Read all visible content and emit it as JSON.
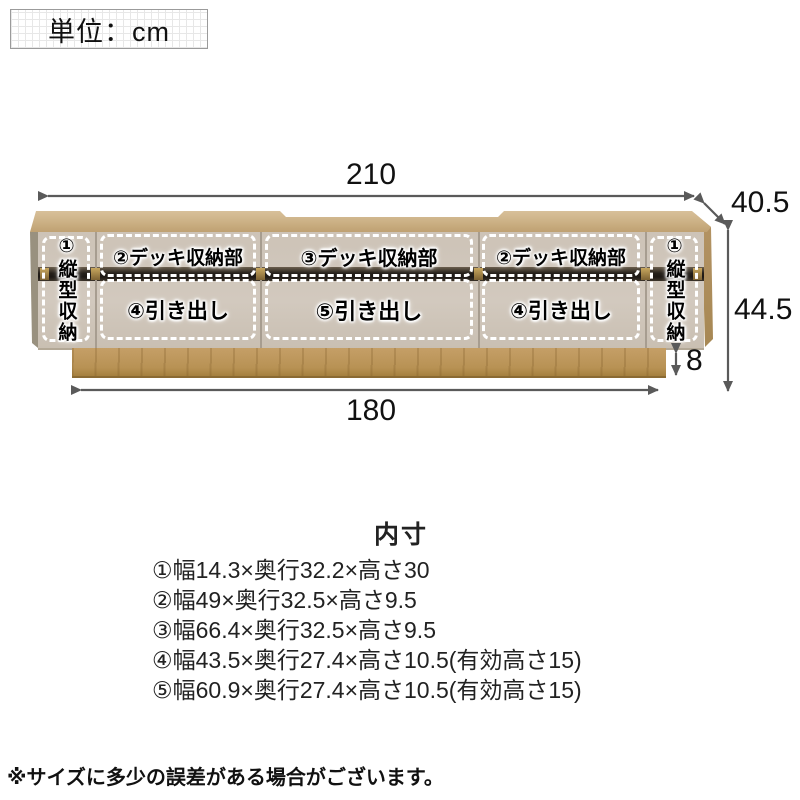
{
  "unit_box": {
    "label": "単位：cm"
  },
  "diagram": {
    "dimensions": {
      "width_total": "210",
      "depth": "40.5",
      "height": "44.5",
      "base_height": "8",
      "base_width": "180"
    },
    "compartments": {
      "left_vertical": "①縦型収納",
      "deck_left": "②デッキ収納部",
      "deck_center": "③デッキ収納部",
      "deck_right": "②デッキ収納部",
      "right_vertical": "①縦型収納",
      "drawer_left": "④引き出し",
      "drawer_center": "⑤引き出し",
      "drawer_right": "④引き出し"
    }
  },
  "inner_dimensions": {
    "title": "内寸",
    "items": [
      "①幅14.3×奥行32.2×高さ30",
      "②幅49×奥行32.5×高さ9.5",
      "③幅66.4×奥行32.5×高さ9.5",
      "④幅43.5×奥行27.4×高さ10.5(有効高さ15)",
      "⑤幅60.9×奥行27.4×高さ10.5(有効高さ15)"
    ]
  },
  "footnote": "※サイズに多少の誤差がある場合がございます。",
  "colors": {
    "wood": "#c2a678",
    "base_wood": "#b89254",
    "front_panel": "#cdc3b7",
    "dark_band": "#241f19",
    "brass_accent": "#c8a75e",
    "arrow": "#5a5a5a",
    "outline_dash": "#ffffff"
  }
}
